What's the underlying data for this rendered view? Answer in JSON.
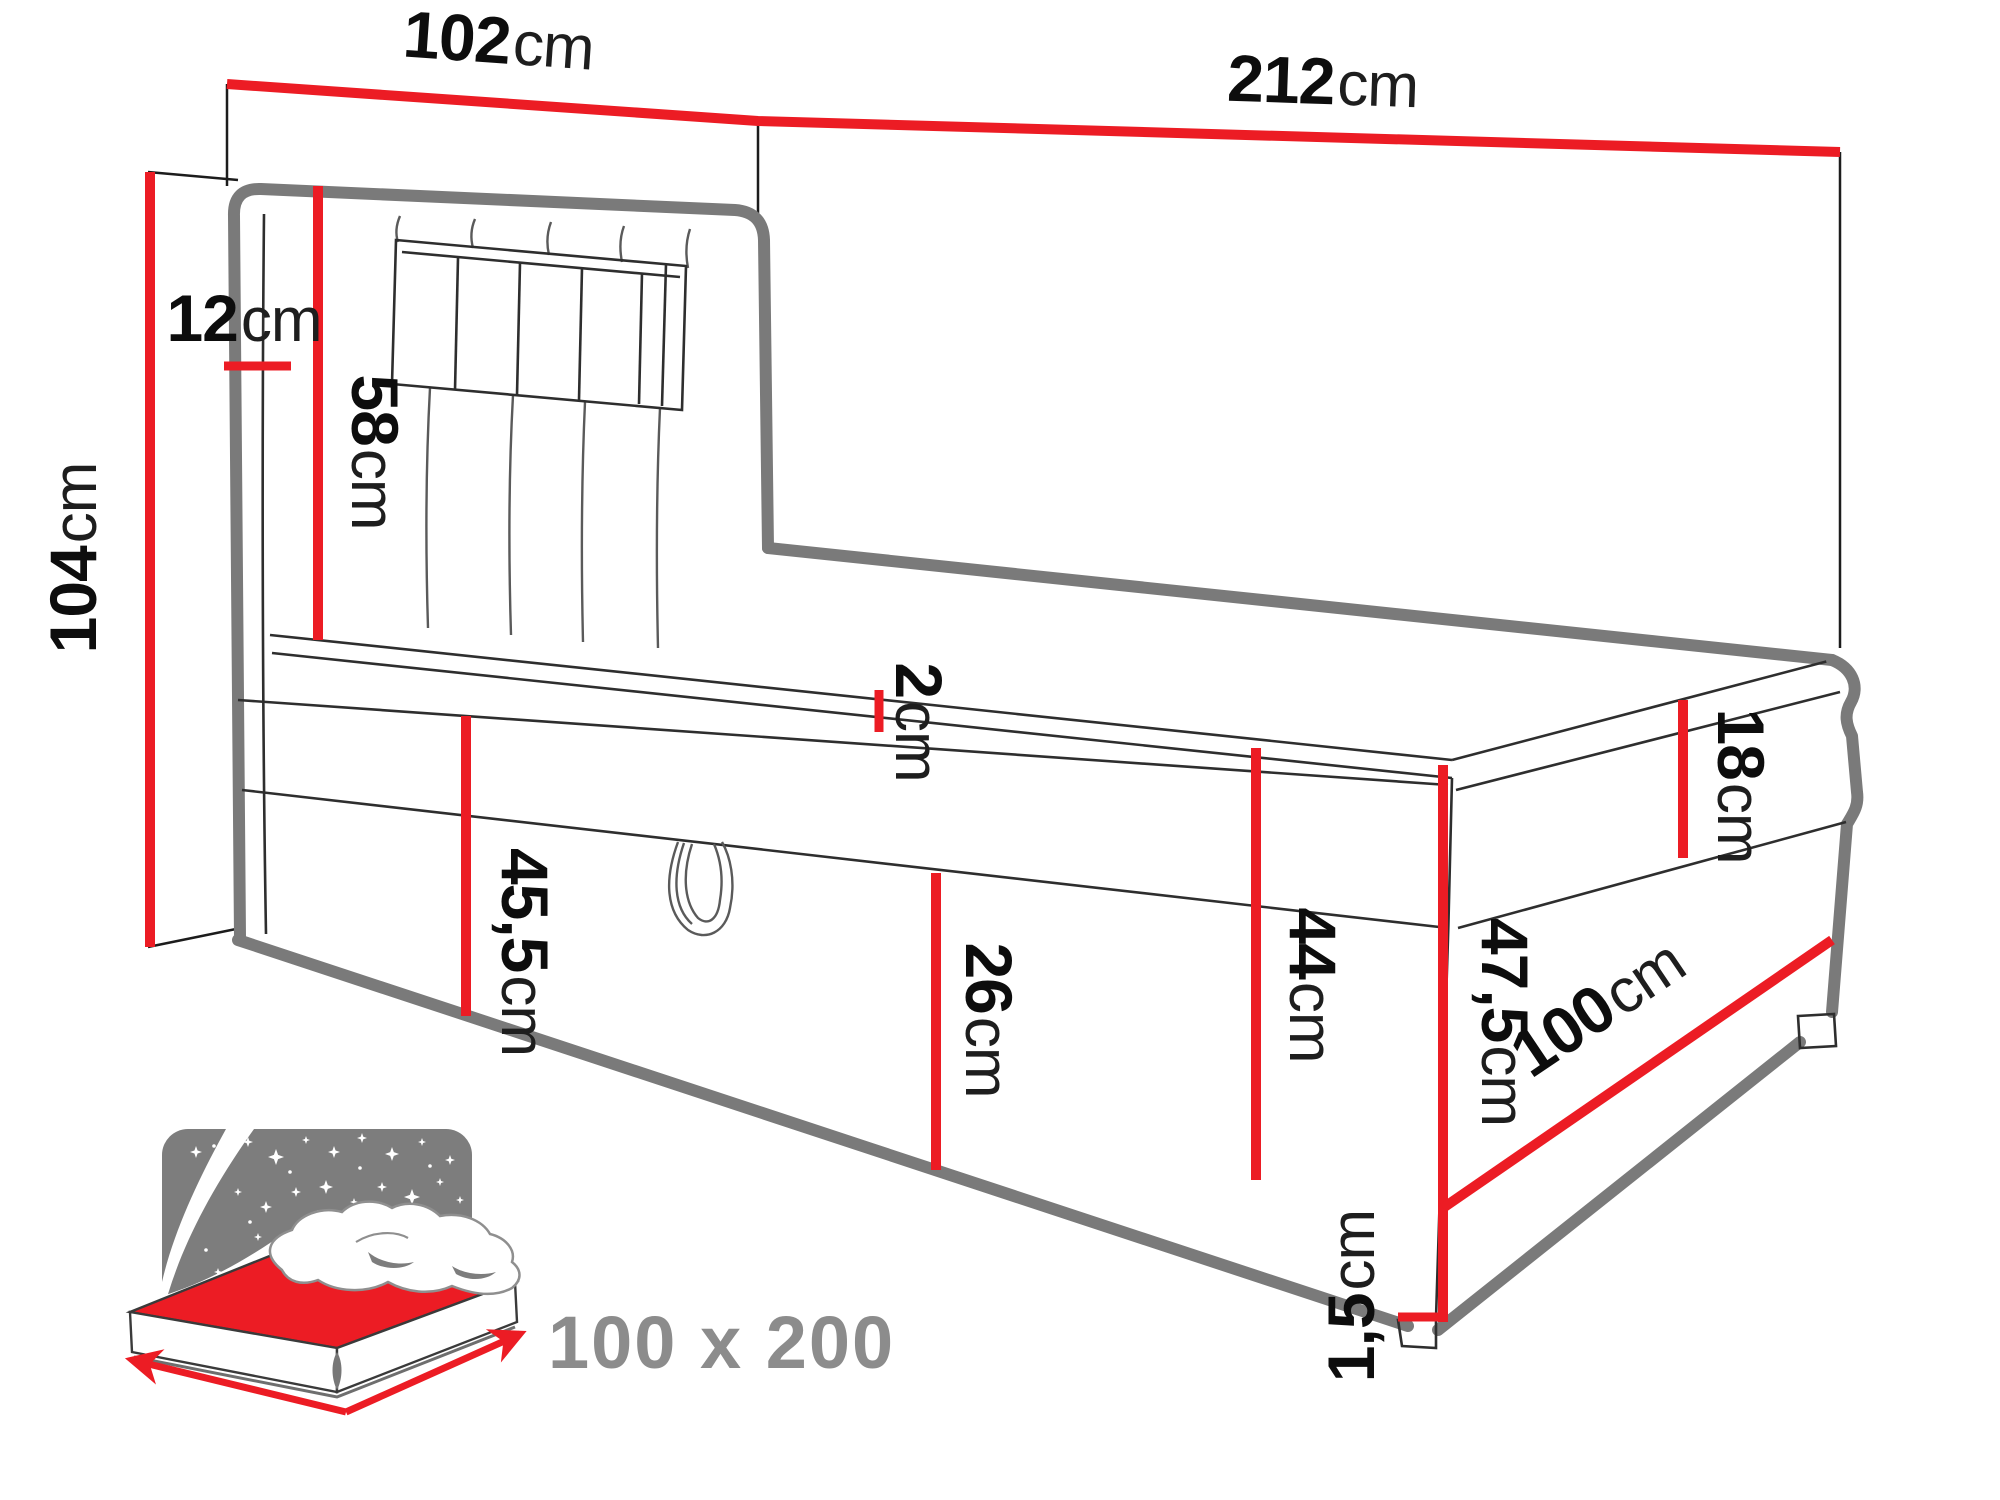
{
  "diagram_title": "boxspring-bed-dimension-diagram",
  "colors": {
    "accent_red": "#ec1c24",
    "outline_gray": "#7a7a7a",
    "icon_gray": "#7d7d7d",
    "text_black": "#0d0d0d",
    "icon_text_gray": "#8c8c8c"
  },
  "dims": {
    "headboard_width": {
      "value": "102",
      "unit": "cm"
    },
    "total_length": {
      "value": "212",
      "unit": "cm"
    },
    "wall_gap": {
      "value": "12",
      "unit": "cm"
    },
    "headboard_panel": {
      "value": "58",
      "unit": "cm"
    },
    "total_height": {
      "value": "104",
      "unit": "cm"
    },
    "topper": {
      "value": "2",
      "unit": "cm"
    },
    "base_height": {
      "value": "45,5",
      "unit": "cm"
    },
    "storage_depth": {
      "value": "26",
      "unit": "cm"
    },
    "side_height": {
      "value": "44",
      "unit": "cm"
    },
    "corner_height": {
      "value": "47,5",
      "unit": "cm"
    },
    "mattress_height": {
      "value": "18",
      "unit": "cm"
    },
    "foot_width": {
      "value": "100",
      "unit": "cm"
    },
    "feet_height": {
      "value": "1,5",
      "unit": "cm"
    }
  },
  "icon": {
    "size_label": "100 x 200"
  }
}
